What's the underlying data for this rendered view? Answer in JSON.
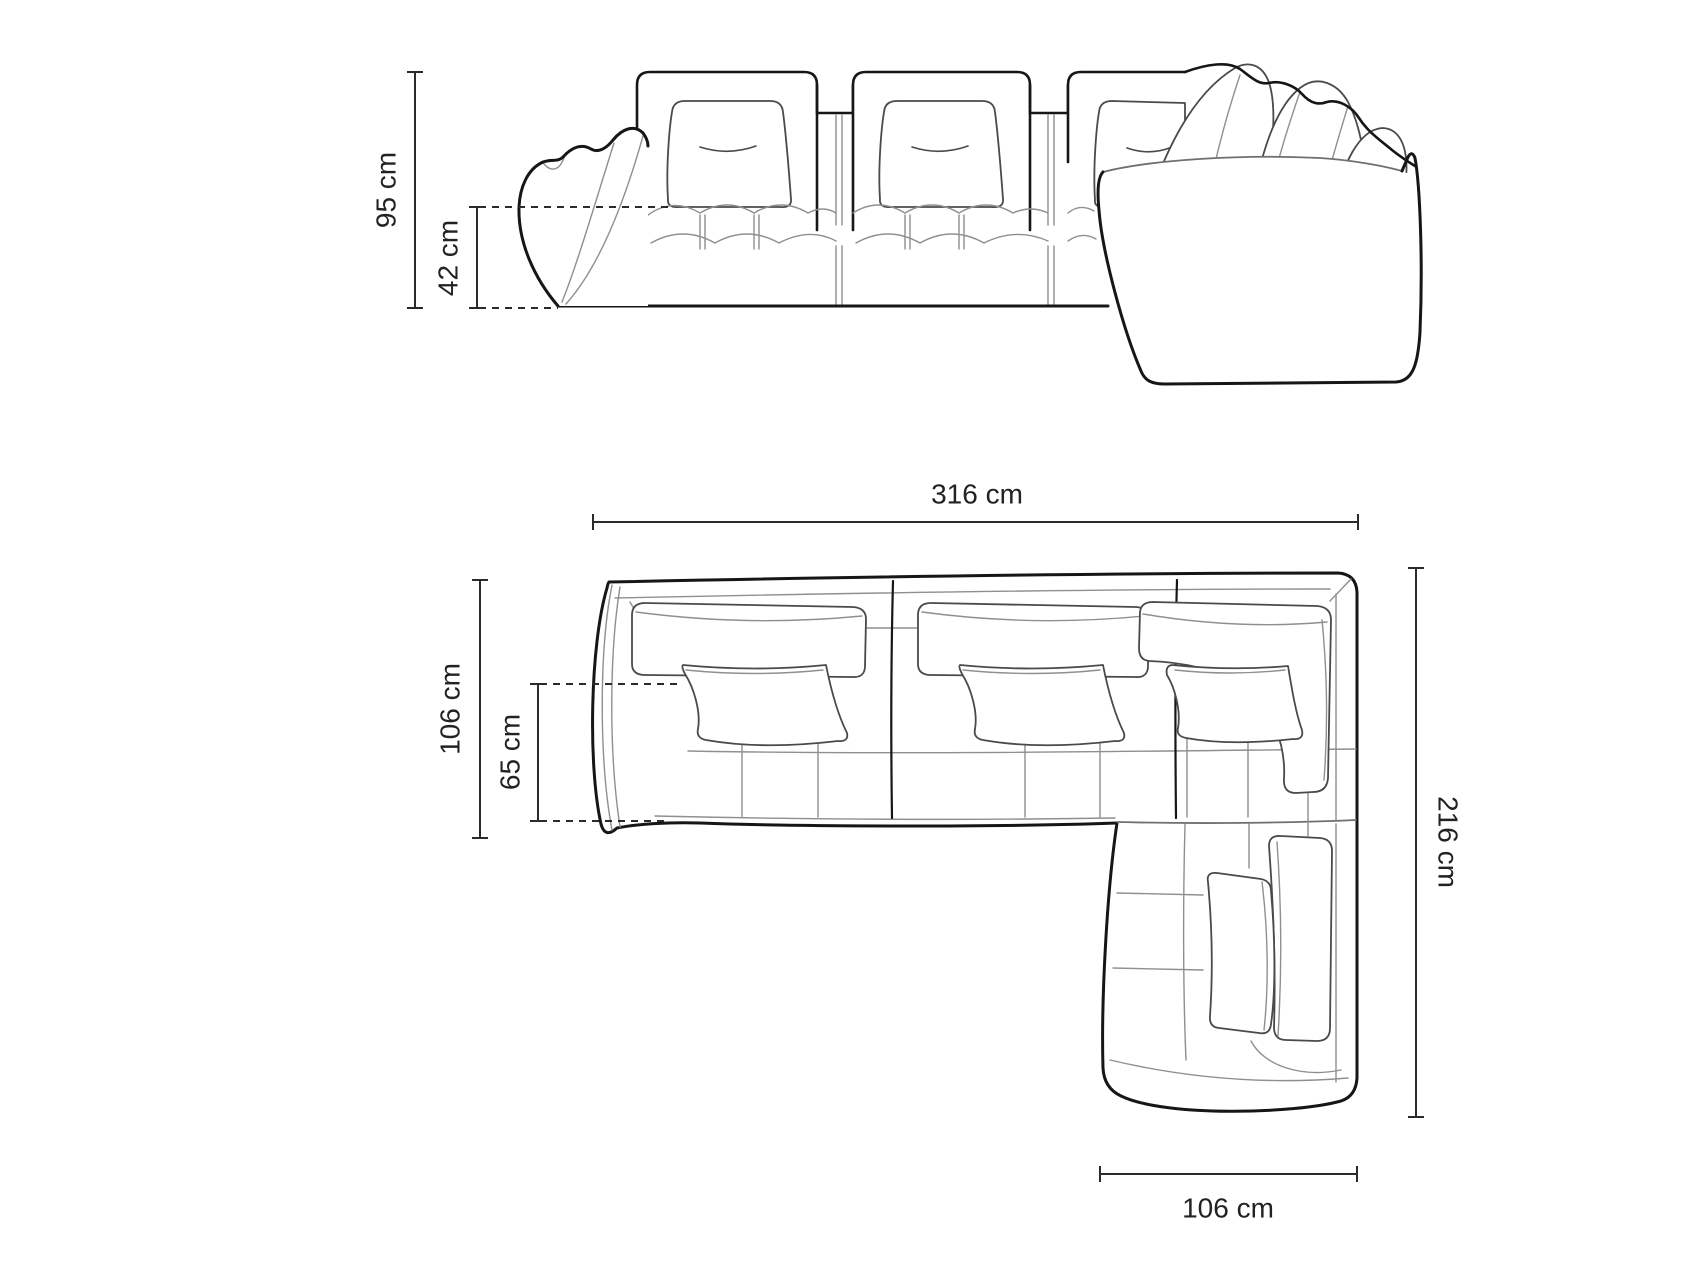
{
  "dimensions": {
    "front": {
      "total_height": "95 cm",
      "seat_height": "42 cm"
    },
    "top": {
      "total_width": "316 cm",
      "total_depth": "106 cm",
      "seat_depth": "65 cm",
      "total_length": "216 cm",
      "chaise_width": "106 cm"
    }
  },
  "colors": {
    "background": "#ffffff",
    "ink_dark": "#161616",
    "ink_mid": "#4a4a4a",
    "ink_light": "#8f8f8f",
    "dimension": "#2b2b2b",
    "label_text": "#222222"
  }
}
